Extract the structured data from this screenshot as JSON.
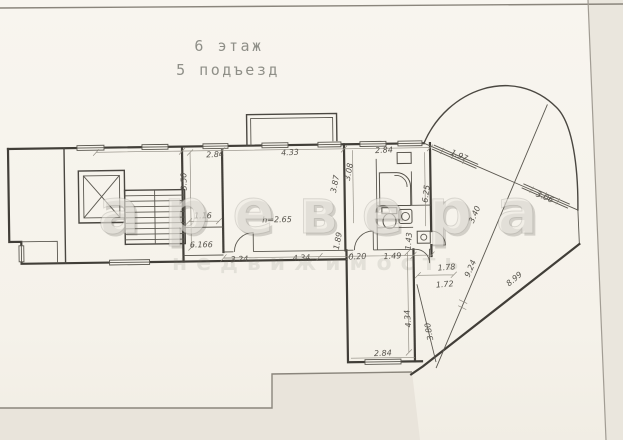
{
  "title": {
    "floor_line": "6 этаж",
    "entrance_line": "5 подъезд"
  },
  "watermark": {
    "primary": "аревера",
    "secondary": "недвижимость"
  },
  "room_labels": {
    "ceiling_height": "h=2.65",
    "area_label": "6.166"
  },
  "dimensions": {
    "top_left_bay": "2.84",
    "top_living": "4.33",
    "top_right_bay": "2.84",
    "stair_hall_depth": "3.50",
    "shaft_width": "1.16",
    "living_depth": "3.87",
    "kitchen_depth": "3.08",
    "kitchen_lower": "1.89",
    "hall_seg_1": "3.24",
    "hall_seg_2": "4.34",
    "hall_seg_3": "0.20",
    "hall_seg_4": "1.49",
    "bath_depth": "1.43",
    "balcony_wall": "6.25",
    "terrace_gap_upper": "1.78",
    "terrace_gap_lower": "1.72",
    "fan_glazing_1": "1.97",
    "fan_glazing_2": "3.06",
    "fan_cross_upper": "3.40",
    "fan_cross_long": "9.24",
    "fan_outer_edge": "8.99",
    "room_depth": "4.34",
    "room_diagonal_wall": "3.80",
    "room_width": "2.84"
  },
  "colors": {
    "paper": "#f6f3ec",
    "ink": "#413e38",
    "dim_text": "#55524b",
    "title_gray": "#8f8f88",
    "backdrop": "#e9e4db"
  }
}
